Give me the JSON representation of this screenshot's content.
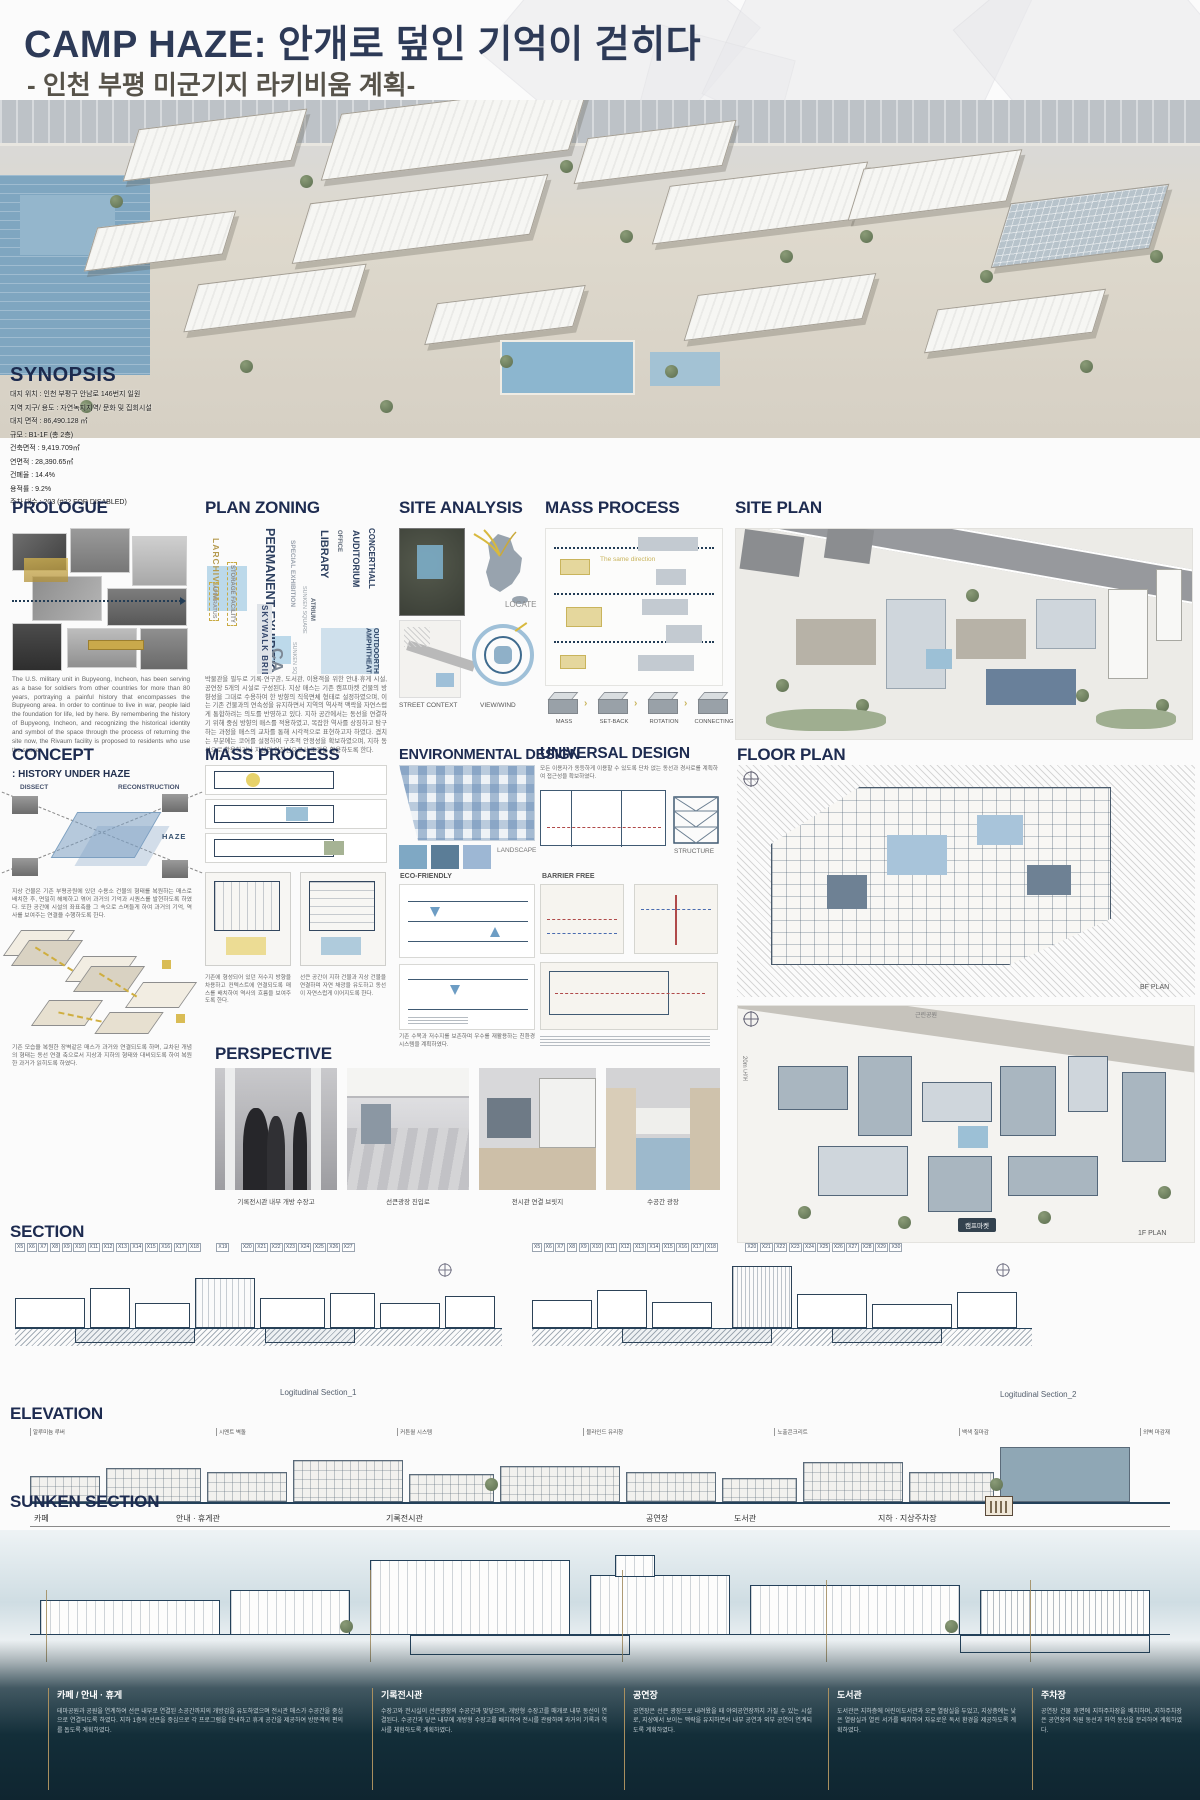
{
  "header": {
    "title": "CAMP HAZE: 안개로 덮인 기억이 걷히다",
    "subtitle": "- 인천 부평 미군기지 라키비움 계획-"
  },
  "synopsis": {
    "heading": "SYNOPSIS",
    "lines": [
      "대지 위치 : 인천 부평구 안남로 146번지 일원",
      "지역 지구/ 용도 : 자연녹지지역/ 문화 및 집회시설",
      "대지 면적 : 86,490.128 ㎡",
      "규모 : B1-1F (총 2층)",
      "건축면적 : 9,419.709㎡",
      "연면적 : 28,390.65㎡",
      "건폐율 : 14.4%",
      "용적률 : 9.2%",
      "주차 대수 : 203 (#22 FOR DISABLED)"
    ]
  },
  "prologue": {
    "heading": "PROLOGUE",
    "body": "The U.S. military unit in Bupyeong, Incheon, has been serving as a base for soldiers from other countries for more than 80 years, portraying a painful history that encompasses the Bupyeong area. In order to continue to live in war, people laid the foundation for life, led by here. By remembering the history of Bupyeong, Incheon, and recognizing the historical identity and symbol of the space through the process of returning the site now, the Rivaum facility is proposed to residents who use the space."
  },
  "plan_zoning": {
    "heading": "PLAN ZONING",
    "words": [
      "LARCHIVIUM",
      "STORAGE FACILITY",
      "APPARATUS",
      "PERMANENT EXHIBITION",
      "SPECIAL EXHIBITION",
      "LIBRARY",
      "OFFICE",
      "SUNKEN SQUARE",
      "SKYWALK BRIDGE",
      "ATRIUM",
      "AUDITORIUM",
      "CONCERTHALL",
      "SUNKEN SQUARE",
      "OUTDOORTHEATER AMPHITHEATER",
      "CAFE"
    ],
    "body": "박물관을 필두로 기록·연구관, 도서관, 이용객을 위한 안내·휴게 시설, 공연장 5개의 시설로 구성된다. 지상 매스는 기존 캠프마켓 건물의 방향성을 그대로 수용하여 한 방향의 직육면체 형태로 설정하였으며, 이는 기존 건물과의 연속성을 유지하면서 지역의 역사적 맥락을 자연스럽게 통합하려는 의도를 반영하고 있다. 지하 공간에서는 동선을 연결하기 위해 중심 방향의 매스를 적용하였고, 복잡한 역사를 상징하고 탐구하는 과정을 매스의 교차를 통해 시각적으로 표현하고자 하였다. 겹치는 부분에는 코어를 설정하여 구조적 안정성을 확보하였으며, 지하 동선으로 활용하거나 지상의 연장선으로서 조경을 활용하도록 한다."
  },
  "site_analysis": {
    "heading": "SITE ANALYSIS",
    "locate": "LOCATE",
    "street": "STREET CONTEXT",
    "wind": "VIEW/WIND"
  },
  "mass_process_1": {
    "heading": "MASS PROCESS",
    "note": "The same direction",
    "steps": [
      "MASS",
      "SET-BACK",
      "ROTATION",
      "CONNECTING"
    ]
  },
  "site_plan": {
    "heading": "SITE PLAN"
  },
  "concept": {
    "heading": "CONCEPT",
    "subtitle": ": HISTORY UNDER HAZE",
    "axis1": "DISSECT",
    "axis2": "RECONSTRUCTION",
    "axis3": "HAZE",
    "caption1": "지상 건물은 기존 부평공원에 있던 수용소 건물의 형태를 복원하는 매스로 배치한 후, 면밀히 해체하고 엮어 과거의 기억과 시퀀스를 발현하도록 하였다. 또한 공간에 시설의 좌표축을 그 속으로 스며들게 하여 과거의 기억, 역사를 보여주는 연결을 수행하도록 한다.",
    "caption2": "기존 모습을 복원한 장벽같은 매스가 과거와 연결되도록 하며, 교차된 개념의 형태는 동선 연결 축으로서 지상과 지하의 형태와 대비되도록 하여 복원한 과거가 읽히도록 하였다."
  },
  "mass_process_2": {
    "heading": "MASS PROCESS",
    "caption_left": "기존에 형성되어 있던 저수지 방향을 차용하고 컨텍스트에 연결되도록 매스를 배치하여 역사의 흐름을 보여주도록 한다.",
    "caption_right": "선큰 공간이 지하 건물과 지상 건물을 연결하며 자연 채광을 유도하고 동선이 자연스럽게 이어지도록 한다."
  },
  "environmental": {
    "heading": "ENVIRONMENTAL DESIGN",
    "landscape": "LANDSCAPE",
    "eco": "ECO-FRIENDLY",
    "caption": "기존 수목과 저수지를 보존하며 우수를 재활용하는 친환경 시스템을 계획하였다."
  },
  "universal": {
    "heading": "UNIVERSAL DESIGN",
    "intro": "모든 이용자가 동등하게 이용할 수 있도록 단차 없는 동선과 경사로를 계획하여 접근성을 확보하였다.",
    "structure": "STRUCTURE",
    "barrier": "BARRIER FREE"
  },
  "floor_plan": {
    "heading": "FLOOR PLAN",
    "bf": "BF PLAN",
    "f1": "1F PLAN",
    "park": "근린공원",
    "road": "20m 도로",
    "market": "캠프마켓"
  },
  "perspective": {
    "heading": "PERSPECTIVE",
    "captions": [
      "기록전시관 내부 개방 수장고",
      "선큰광장 진입로",
      "전시관 연결 브릿지",
      "수공간 광장"
    ]
  },
  "sections": {
    "heading": "SECTION",
    "grid_left": [
      "X5",
      "X6",
      "X7",
      "X8",
      "X9",
      "X10",
      "X11",
      "X12",
      "X13",
      "X14",
      "X15",
      "X16",
      "X17",
      "X18",
      "X19",
      "X20",
      "X21",
      "X22",
      "X23",
      "X24",
      "X25",
      "X26",
      "X27"
    ],
    "grid_right": [
      "X5",
      "X6",
      "X7",
      "X8",
      "X9",
      "X10",
      "X11",
      "X12",
      "X13",
      "X14",
      "X15",
      "X16",
      "X17",
      "X18",
      "X20",
      "X21",
      "X22",
      "X23",
      "X24",
      "X25",
      "X26",
      "X27",
      "X28",
      "X29",
      "X30"
    ],
    "captions": [
      "Logitudinal Section_1",
      "Logitudinal Section_2"
    ]
  },
  "elevation": {
    "heading": "ELEVATION",
    "labels": [
      "알루미늄 루버",
      "시멘트 벽돌",
      "커튼월 시스템",
      "블라인드 유리창",
      "노출콘크리트",
      "백색 칠마감",
      "외벽 마감재"
    ]
  },
  "sunken": {
    "heading": "SUNKEN SECTION",
    "top_labels": [
      "카페",
      "안내 · 휴게관",
      "기록전시관",
      "공연장",
      "도서관",
      "지하 · 지상주차장"
    ]
  },
  "band": {
    "columns": [
      {
        "title": "카페 / 안내 · 휴게",
        "body": "테마공원과 공원을 연계하여 선큰 내부로 연결된 소공간까지의 개방감을 유도하였으며 전시관 매스가 수공간을 중심으로 연결되도록 하였다. 지하 1층의 선큰을 중심으로 각 프로그램을 안내하고 휴게 공간을 제공하여 방문객의 편의를 돕도록 계획하였다."
      },
      {
        "title": "기록전시관",
        "body": "수장고와 전시실이 선큰광장의 수공간과 맞닿으며, 개방형 수장고를 매개로 내부 동선이 연결된다. 수공간과 닿은 내부에 개방형 수장고를 배치하여 전시를 관람하며 과거의 기록과 역사를 체험하도록 계획하였다."
      },
      {
        "title": "공연장",
        "body": "공연장은 선큰 광장으로 내려왔을 때 야외공연장까지 가질 수 있는 시설로, 지상에서 보이는 맥락을 유지하면서 내부 공연과 외부 공연이 연계되도록 계획하였다."
      },
      {
        "title": "도서관",
        "body": "도서관은 지하층에 어린이도서관과 오픈 열람실을 두었고, 지상층에는 낮은 열람실과 열린 서가를 배치하여 자유로운 독서 환경을 제공하도록 계획하였다."
      },
      {
        "title": "주차장",
        "body": "공연장 건물 후면에 지하주차장을 배치하며, 지하주차장은 공연장의 직원 동선과 하역 동선을 분리하여 계획하였다."
      }
    ]
  }
}
